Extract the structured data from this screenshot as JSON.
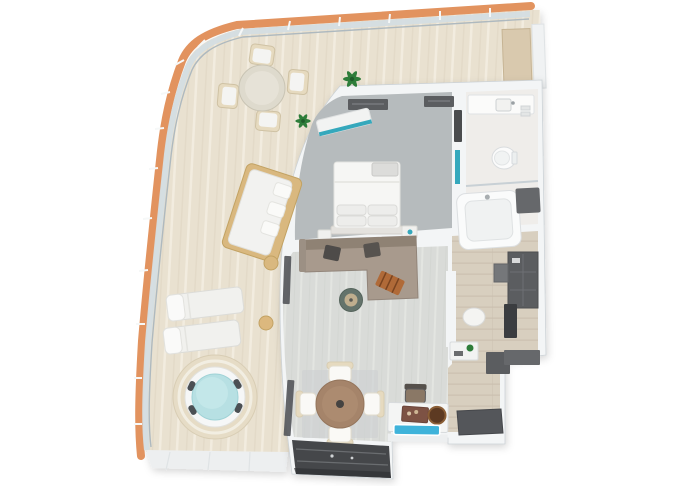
{
  "scene": {
    "description": "3D top-down floor plan of a ship suite with wrap-around balcony, hot tub, bedroom, bathroom, living-dining room and entry hall",
    "view": "top-down-3d-render",
    "background": "#ffffff"
  },
  "palette": {
    "hull_orange": "#e2935f",
    "railing_glass": "#d4dde2",
    "railing_frame": "#aeb9bf",
    "railing_post": "#f6f8f8",
    "deck_wood": "#e9e1d0",
    "deck_plank_light": "#f3eee2",
    "deck_plank_shadow": "#ddd3c0",
    "deck_platform": "#edeff0",
    "wall": "#f3f5f6",
    "wall_edge": "#ccd2d6",
    "bedroom_carpet": "#b6bbbd",
    "living_floor": "#d9dbd8",
    "living_plank_light": "#e5e7e3",
    "entry_floor": "#d8cfbf",
    "entry_plank_line": "#c8bdac",
    "bathroom_floor": "#efedea",
    "dark_cabinet": "#5b5d60",
    "window_glass": "#45474a",
    "sofa_taupe": "#a89a8d",
    "sofa_back": "#8f8274",
    "pillow_dark": "#4e4b49",
    "throw_orange": "#b06a38",
    "coffee_table_green": "#64736b",
    "bed_white": "#f6f6f4",
    "accent_teal": "#35a8bc",
    "tub_water": "#b7e0e3",
    "tub_platform": "#e6dcc6",
    "sink_blue": "#3fb3da",
    "dining_wood": "#a5846a",
    "chair_cream": "#e6dabf",
    "plant_green": "#2e7d3a",
    "white_furniture": "#f2f3f2",
    "tray_brown": "#7d5244",
    "bowl_brown": "#5d3a22",
    "mat_dark": "#54565a",
    "partition_tan": "#d9c9ae"
  },
  "areas": [
    {
      "id": "balcony-terrace",
      "furniture": [
        "outdoor-dining-table",
        "outdoor-chair x4",
        "plant x2",
        "day-bed",
        "side-table x2",
        "sun-lounger x2",
        "hot-tub",
        "privacy-partition"
      ]
    },
    {
      "id": "bedroom",
      "furniture": [
        "double-bed",
        "pillows",
        "nightstand x2",
        "window-bench",
        "wardrobe-strip x2",
        "tv-panel",
        "mirror"
      ]
    },
    {
      "id": "bathroom",
      "furniture": [
        "vanity-counter",
        "basin",
        "toilet",
        "bathtub",
        "shower-mat"
      ]
    },
    {
      "id": "living-room",
      "furniture": [
        "corner-sofa",
        "dark-pillow x2",
        "throw-blanket",
        "coffee-table",
        "glass-door x2"
      ]
    },
    {
      "id": "dining-area",
      "furniture": [
        "rug",
        "dining-table",
        "dining-chair x4"
      ]
    },
    {
      "id": "bar",
      "furniture": [
        "bar-counter",
        "serving-tray",
        "ice-bowl",
        "bar-sink",
        "desk-chair"
      ]
    },
    {
      "id": "entry-hall",
      "furniture": [
        "wardrobe",
        "vanity-desk",
        "vanity-stool",
        "entry-door",
        "console-table",
        "plant-pot",
        "shoe-cabinet",
        "doormat"
      ]
    }
  ]
}
